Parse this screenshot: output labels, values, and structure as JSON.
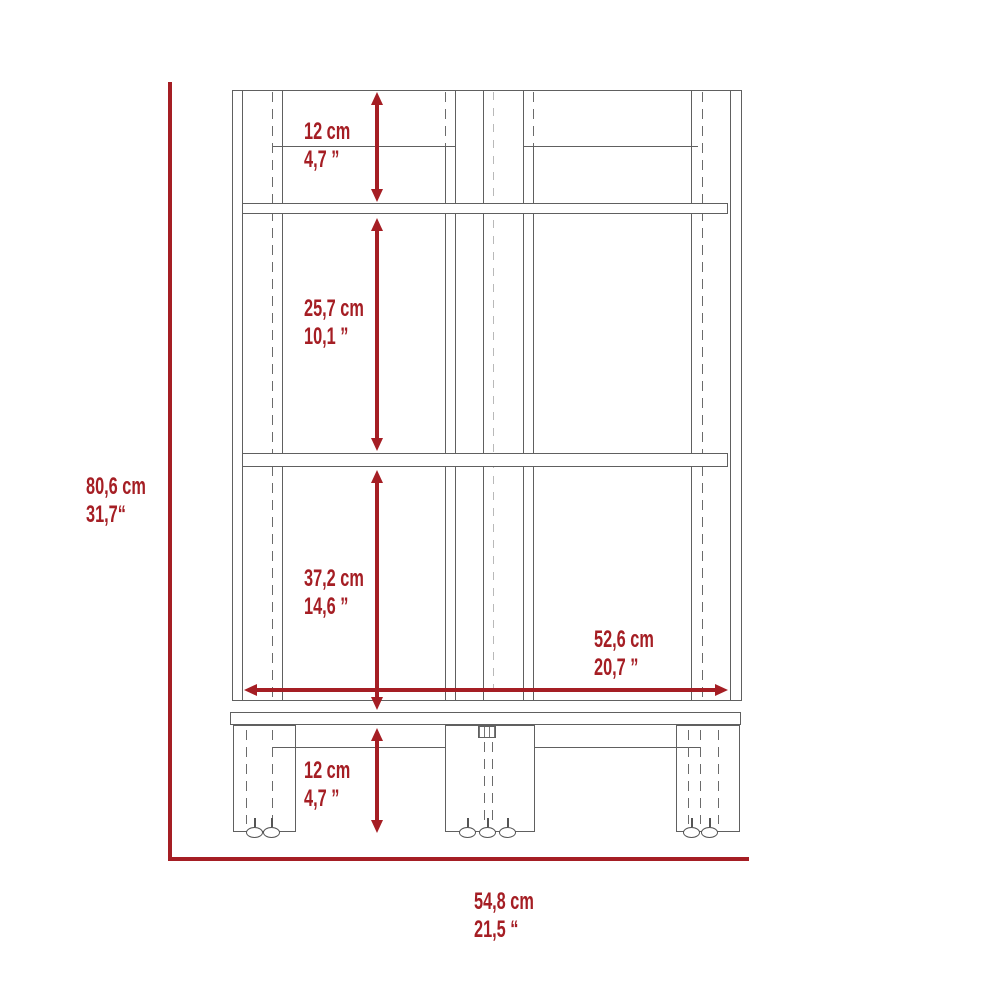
{
  "colors": {
    "dimension_accent": "#A51E24",
    "outline_gray": "#606060",
    "hidden_line_gray": "#B9B9B9"
  },
  "dimensions": {
    "overall_height": {
      "cm": "80,6 cm",
      "inches": "31,7“"
    },
    "overall_width": {
      "cm": "54,8 cm",
      "inches": "21,5 “"
    },
    "top_section": {
      "cm": "12 cm",
      "inches": "4,7 ”"
    },
    "middle_section": {
      "cm": "25,7 cm",
      "inches": "10,1 ”"
    },
    "lower_section": {
      "cm": "37,2 cm",
      "inches": "14,6 ”"
    },
    "inner_width": {
      "cm": "52,6 cm",
      "inches": "20,7 ”"
    },
    "leg_height": {
      "cm": "12 cm",
      "inches": "4,7 ”"
    }
  }
}
